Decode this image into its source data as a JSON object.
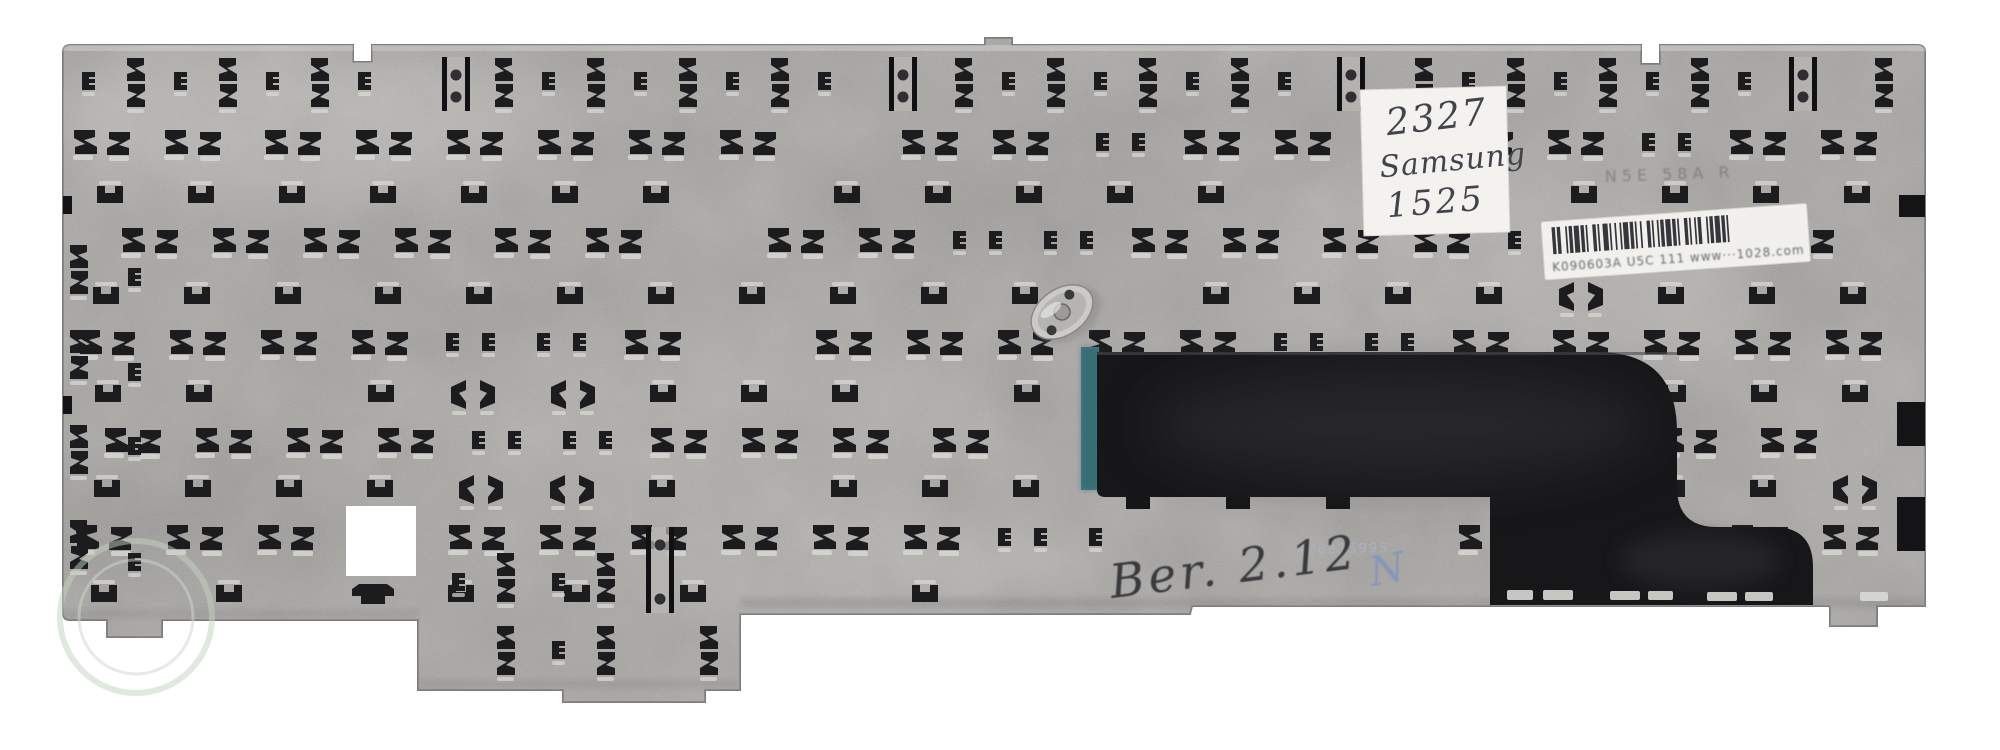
{
  "image": {
    "title": "Rear side of a laptop keyboard metal backplate",
    "width": 2000,
    "height": 750,
    "background": "#ffffff"
  },
  "sticker": {
    "line1": "2327",
    "line2": "Samsung",
    "line3": "1525"
  },
  "barcode_label": {
    "text": "K090603A U5C 111   www···1028.com",
    "bars": "212311213121132112311212113121121321121121312113211211231121312112"
  },
  "stamp": {
    "text": "N5E 58A R"
  },
  "serial": {
    "text": "406835995"
  },
  "handwriting": {
    "text": "Ber. 2.12",
    "mark": "N"
  },
  "colors": {
    "plate_base": "#a7a5a2",
    "plate_edge": "#7e7d7b",
    "cutout": "#1c1c1f",
    "cutout_highlight": "#dbdad6",
    "mylar_black": "#17171a",
    "teal_edge": "#3f7d85",
    "sticker_paper": "#f4f2ef",
    "label_paper": "#f1f0ec",
    "handwriting_ink": "#3a3a3e",
    "blue_mark": "#8398ba",
    "watermark_green": "#c3d2c0"
  },
  "plate_pattern": {
    "bands": [
      {
        "type": "sz",
        "y": 130,
        "start": 76,
        "period": 92,
        "count": 20,
        "skips": [
          8,
          14
        ],
        "clips": [
          11,
          17
        ]
      },
      {
        "type": "u",
        "y": 186,
        "start": 95,
        "period": 92,
        "count": 20,
        "skips": [
          7,
          13
        ],
        "butterflies": []
      },
      {
        "type": "sz",
        "y": 228,
        "start": 122,
        "period": 92,
        "count": 19,
        "skips": [
          6
        ],
        "clips": [
          9,
          10,
          15
        ]
      },
      {
        "type": "u",
        "y": 287,
        "start": 95,
        "period": 92,
        "count": 20,
        "skips": [
          11
        ],
        "butterflies": [
          16
        ]
      },
      {
        "type": "sz",
        "y": 330,
        "start": 76,
        "period": 92,
        "count": 20,
        "skips": [
          7
        ],
        "clips": [
          4,
          5,
          13,
          14
        ]
      },
      {
        "type": "u",
        "y": 385,
        "start": 95,
        "period": 92,
        "count": 20,
        "skips": [
          2,
          9
        ],
        "butterflies": [
          4,
          5
        ]
      },
      {
        "type": "sz",
        "y": 428,
        "start": 100,
        "period": 92,
        "count": 19,
        "skips": [
          10
        ],
        "clips": [
          4,
          5,
          16
        ]
      },
      {
        "type": "u",
        "y": 480,
        "start": 95,
        "period": 92,
        "count": 20,
        "skips": [
          7
        ],
        "butterflies": [
          4,
          5,
          19
        ]
      },
      {
        "type": "sz",
        "y": 525,
        "start": 76,
        "period": 92,
        "count": 20,
        "skips": [
          3
        ],
        "clips": [
          10,
          11
        ]
      },
      {
        "type": "u",
        "y": 585,
        "start": 95,
        "period": 117,
        "count": 16,
        "skips": [
          2,
          6
        ],
        "butterflies": [
          8,
          15
        ]
      }
    ],
    "fn_row": {
      "y": 58,
      "clip_start": 82,
      "vpair_start": 127,
      "period": 92,
      "count": 20,
      "bracket_x": [
        456,
        903,
        1351,
        1803
      ]
    },
    "left_column": {
      "vpair_x": 70,
      "vpair_ys": [
        245,
        330,
        425,
        520
      ],
      "clip_x": 128,
      "clip_ys": [
        268,
        363,
        437,
        553
      ]
    },
    "foot": {
      "clips": [
        [
          452,
          573
        ],
        [
          552,
          573
        ],
        [
          552,
          641
        ]
      ],
      "vpairs": [
        [
          497,
          553
        ],
        [
          597,
          553
        ],
        [
          497,
          626
        ],
        [
          597,
          626
        ],
        [
          700,
          626
        ]
      ],
      "flat": [
        352,
        584
      ],
      "bracket": {
        "x": 660,
        "y1": 527,
        "y2": 613
      }
    },
    "holes": [
      {
        "x": 340,
        "y": 500,
        "w": 80,
        "h": 80
      },
      {
        "x": 1100,
        "y": 528,
        "w": 320,
        "h": 95
      }
    ],
    "bottoms": [
      [
        418,
        616
      ],
      [
        740,
        686
      ],
      [
        1190,
        610
      ],
      [
        2000,
        602
      ]
    ],
    "edge_notches": {
      "right": [
        [
          1899,
          195,
          26,
          22
        ],
        [
          1897,
          402,
          28,
          44
        ],
        [
          1897,
          497,
          28,
          54
        ]
      ],
      "left": [
        [
          63,
          196,
          9,
          18
        ],
        [
          63,
          396,
          9,
          18
        ]
      ]
    },
    "mylar_tabs": [
      [
        1126,
        497,
        24,
        12
      ],
      [
        1226,
        497,
        24,
        12
      ],
      [
        1326,
        497,
        24,
        12
      ]
    ],
    "mylar_dashes": [
      [
        1507,
        590,
        26,
        10
      ],
      [
        1543,
        590,
        30,
        10
      ],
      [
        1610,
        591,
        30,
        9
      ],
      [
        1648,
        591,
        25,
        9
      ],
      [
        1707,
        592,
        30,
        9
      ],
      [
        1745,
        592,
        28,
        9
      ],
      [
        1860,
        592,
        28,
        9
      ]
    ]
  }
}
